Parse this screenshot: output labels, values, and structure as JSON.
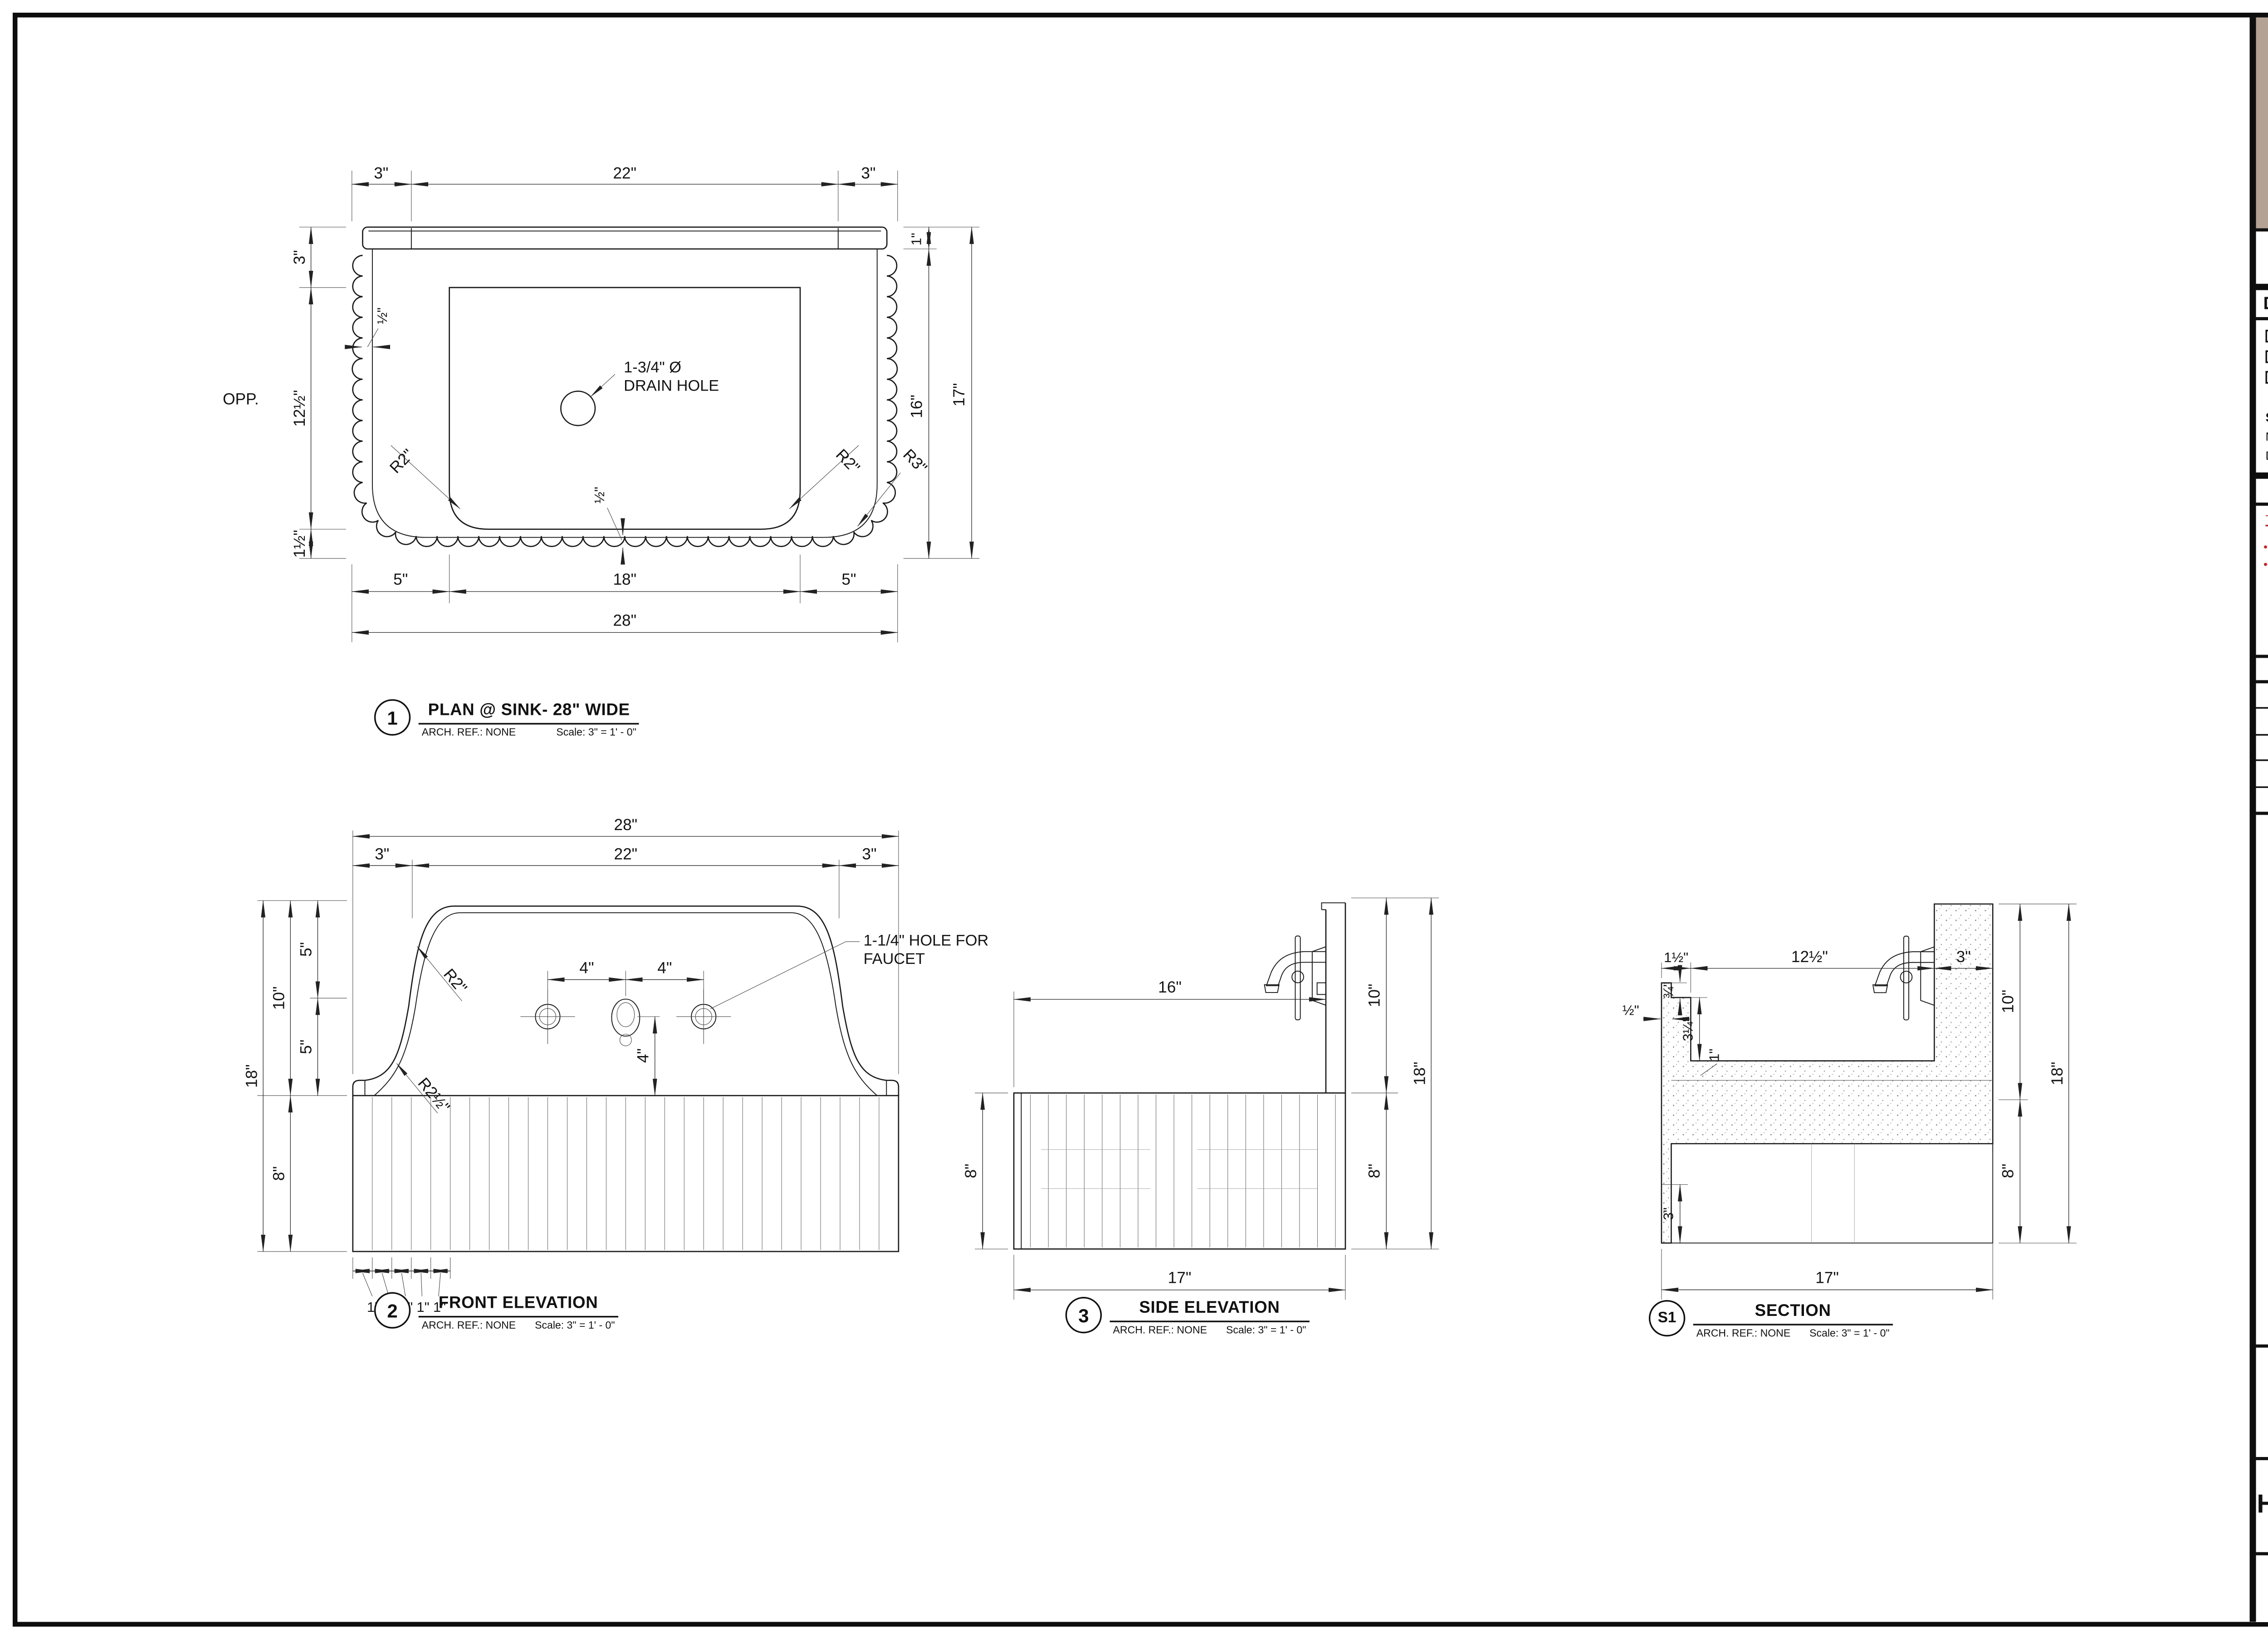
{
  "sheet": {
    "logo_text": "Cultheir",
    "studio_name": "STUDIO LAKIR",
    "studio_sub": "DRAFTING SERVICES",
    "status": {
      "title": "DRAWING STATUS",
      "options": [
        "IN PROGRESS",
        "APPROVED",
        "FOR PRODUCTION"
      ]
    },
    "signed": {
      "title": "SIGNED BY:",
      "name_label": "NAME :",
      "date_label": "Date:"
    },
    "notes": {
      "title": "NOTES",
      "tolerance_title": "TOLERANCE NOTES:",
      "items": [
        "MILLWORK: --",
        "STONE: --"
      ]
    },
    "revisions": {
      "title": "REVISIONS",
      "rows": [
        "1",
        "2",
        "3",
        "4",
        "5"
      ]
    },
    "project": {
      "project_name_label": "PROJECT NAME:",
      "project_no_label": "PROJECT NO.",
      "project_no_value": "--",
      "date_label": "DATE:",
      "date_value": "10.13.25",
      "drawn_by": "DRAWN BY: LC",
      "scale": "SCALE:  AS SHOWN (SHEET SIZE ARCH D-24X36)",
      "views_label": "DRAWING VIEWS:",
      "views_value": "PLAN, ELEVATIONS, SECTIONS"
    },
    "room": {
      "label": "ROOM NAME",
      "value": "--"
    },
    "title": {
      "label": "DRAWING TITLE",
      "value": "HULUSI SINK"
    },
    "sheet_no": {
      "label": "SHEET NO.",
      "value": "1.1"
    },
    "colors": {
      "logo_bg": "#b4a294",
      "logo_text": "#4e3f30",
      "accent_red": "#c0272d"
    }
  },
  "views": {
    "plan": {
      "callout": {
        "num": "1",
        "title": "PLAN @ SINK- 28\" WIDE",
        "ref": "ARCH. REF.: NONE",
        "scale": "Scale: 3\" = 1' - 0\""
      },
      "dims": {
        "top_left": "3\"",
        "top_mid": "22\"",
        "top_right": "3\"",
        "right_band": "1\"",
        "right_inner": "16\"",
        "right_total": "17\"",
        "left_top": "3\"",
        "left_mid": "12½\"",
        "left_bot": "1½\"",
        "opp": "OPP.",
        "wall": "½\"",
        "bottom_left": "5\"",
        "bottom_mid": "18\"",
        "bottom_right": "5\"",
        "bottom_total": "28\"",
        "r_left": "R2\"",
        "r_right": "R2\"",
        "r_corner": "R3\"",
        "half_bottom": "½\""
      },
      "drain_note_1": "1-3/4\" Ø",
      "drain_note_2": "DRAIN HOLE"
    },
    "front": {
      "callout": {
        "num": "2",
        "title": "FRONT ELEVATION",
        "ref": "ARCH. REF.: NONE",
        "scale": "Scale: 3\" = 1' - 0\""
      },
      "dims": {
        "top_total": "28\"",
        "top_left": "3\"",
        "top_mid": "22\"",
        "top_right": "3\"",
        "holes_l": "4\"",
        "holes_r": "4\"",
        "hole_v": "4\"",
        "left_total": "18\"",
        "left_splash": "10\"",
        "left_5a": "5\"",
        "left_5b": "5\"",
        "left_base": "8\"",
        "flutes": [
          "1\"",
          "1\"",
          "1\"",
          "1\"",
          "1\""
        ],
        "r_top": "R2\"",
        "r_bot": "R2½\""
      },
      "faucet_note_1": "1-1/4\" HOLE FOR",
      "faucet_note_2": "FAUCET"
    },
    "side": {
      "callout": {
        "num": "3",
        "title": "SIDE ELEVATION",
        "ref": "ARCH. REF.: NONE",
        "scale": "Scale: 3\" = 1' - 0\""
      },
      "dims": {
        "depth": "16\"",
        "splash": "10\"",
        "total": "18\"",
        "base_right": "8\"",
        "base_left": "8\"",
        "bottom": "17\""
      }
    },
    "section": {
      "callout": {
        "num": "S1",
        "title": "SECTION",
        "ref": "ARCH. REF.: NONE",
        "scale": "Scale: 3\" = 1' - 0\""
      },
      "dims": {
        "top_left": "1½\"",
        "top_mid": "12½\"",
        "top_right": "3\"",
        "wall": "½\"",
        "lip": "¾\"",
        "basin": "3¼\"",
        "floor": "1\"",
        "toe": "3\"",
        "splash": "10\"",
        "total": "18\"",
        "base": "8\"",
        "bottom": "17\""
      }
    }
  }
}
